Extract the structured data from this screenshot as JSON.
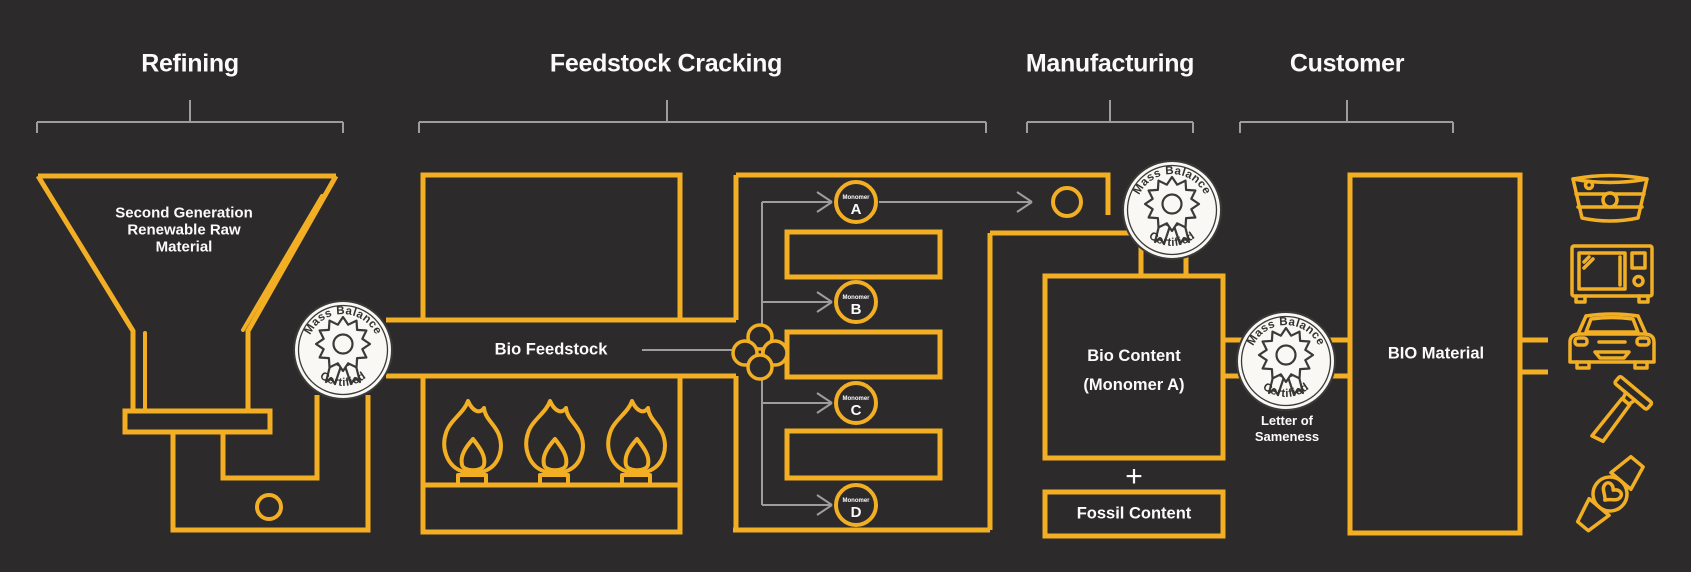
{
  "colors": {
    "background": "#2d2a2c",
    "accent_yellow": "#F2AF24",
    "line_gray": "#9d9d9b",
    "text_white": "#fbfbfb",
    "badge_background": "#FAF8F4",
    "badge_ink": "#3b3a38"
  },
  "sections": {
    "refining": {
      "title": "Refining"
    },
    "feedstock_cracking": {
      "title": "Feedstock Cracking"
    },
    "manufacturing": {
      "title": "Manufacturing"
    },
    "customer": {
      "title": "Customer"
    }
  },
  "refining": {
    "funnel_line1": "Second Generation",
    "funnel_line2": "Renewable Raw",
    "funnel_line3": "Material"
  },
  "feedstock": {
    "bio_feedstock_label": "Bio Feedstock",
    "monomer_prefix": "Monomer",
    "monomers": [
      {
        "letter": "A"
      },
      {
        "letter": "B"
      },
      {
        "letter": "C"
      },
      {
        "letter": "D"
      }
    ]
  },
  "manufacturing": {
    "bio_content_line1": "Bio Content",
    "bio_content_line2": "(Monomer A)",
    "plus_sign": "+",
    "fossil_content_label": "Fossil Content",
    "letter_of_sameness_line1": "Letter of",
    "letter_of_sameness_line2": "Sameness"
  },
  "customer": {
    "bio_material_label": "BIO Material",
    "product_icons": [
      "tub-icon",
      "microwave-icon",
      "car-icon",
      "razor-icon",
      "smartwatch-icon"
    ]
  },
  "badge": {
    "top": "Mass Balance",
    "bottom": "Certified"
  }
}
